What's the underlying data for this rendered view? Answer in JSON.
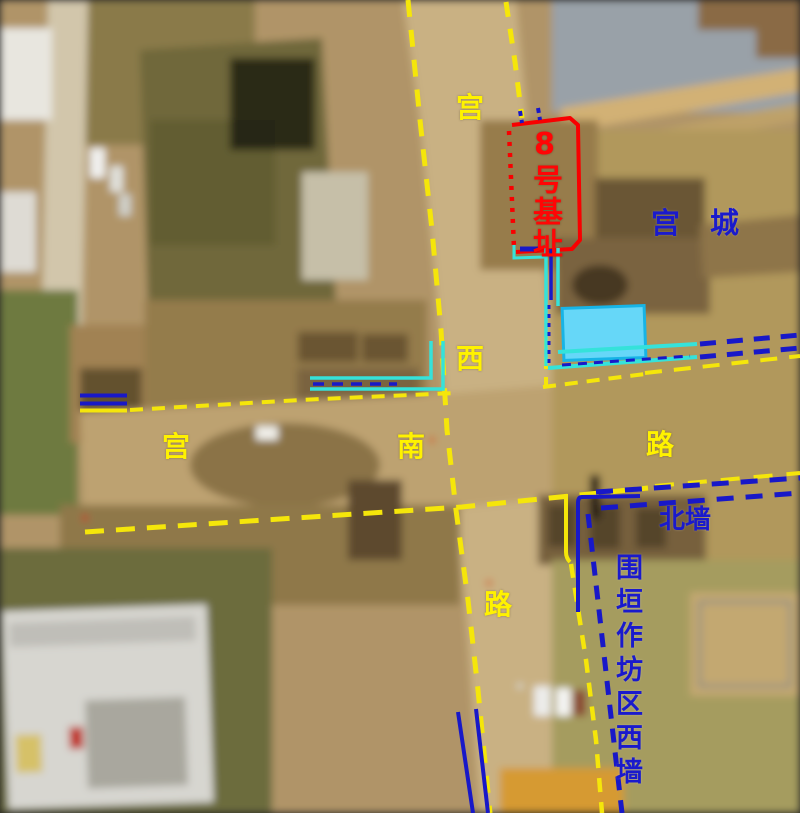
{
  "image": {
    "type": "annotated-aerial-photograph",
    "width": 800,
    "height": 813
  },
  "labels": {
    "road_vertical_char1": {
      "text": "宫"
    },
    "road_vertical_char2": {
      "text": "西"
    },
    "road_vertical_char3": {
      "text": "路"
    },
    "road_horizontal_char1": {
      "text": "宫"
    },
    "road_horizontal_char2": {
      "text": "南"
    },
    "road_horizontal_char3": {
      "text": "路"
    },
    "site_no8": {
      "text": "8号基址"
    },
    "palace_city": {
      "text": "宫城"
    },
    "north_wall": {
      "text": "北墙"
    },
    "workshop_west_wall": {
      "text": "围垣作坊区西墙"
    }
  },
  "colors": {
    "road_line_yellow": "#F5E60A",
    "wall_line_blue": "#1818C8",
    "channel_cyan": "#35E2DA",
    "pool_fill": "#66D7F8",
    "pool_border": "#17B4E6",
    "site_outline_red": "#F80000",
    "label_yellow": "#FFF200",
    "label_blue": "#1A1ACC",
    "label_red": "#FF0505"
  }
}
